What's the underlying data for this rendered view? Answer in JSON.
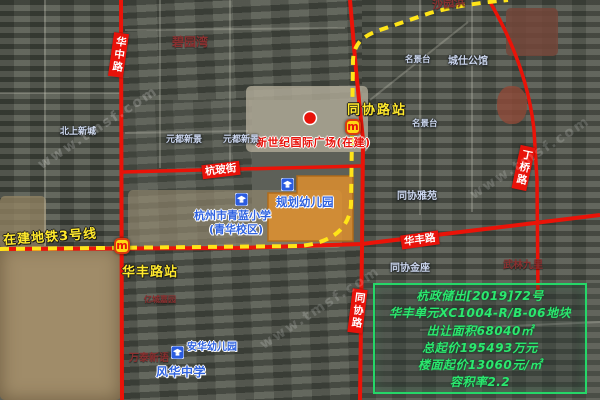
{
  "watermark": "www.tmsf.com",
  "roads": {
    "huazhong": "华中路",
    "hangbo": "杭玻街",
    "huafeng": "华丰路",
    "tongxie": "同协路",
    "dingqiao": "丁桥路"
  },
  "metro": {
    "line_label": "在建地铁3号线",
    "station_tongxie": "同协路站",
    "station_huafeng": "华丰路站",
    "logo_letter": "m"
  },
  "landmarks": {
    "plaza": "新世纪国际广场(在建)",
    "kindergarten_planned": "规划幼儿园",
    "school_line1": "杭州市青蓝小学",
    "school_line2": "(青华校区)",
    "anhua_kindergarten": "安华幼儿园",
    "fenghua_school": "风华中学"
  },
  "poi": {
    "beishang": "北上新城",
    "yuandu1": "元都新景",
    "yuandu2": "元都新景",
    "biyuanwan": "碧园湾",
    "shayuanbang": "沙园浜",
    "mingjingtai1": "名景台",
    "chengshi": "城仕公馆",
    "mingjingtai2": "名景台",
    "tongxieyayuan": "同协雅苑",
    "tongxiejinzuo": "同协金座",
    "wulin": "武林九里",
    "yicheng": "亿城嘉园",
    "wantai": "万泰新语"
  },
  "parcel_notice": {
    "lines": [
      "杭政储出[2019]72号",
      "华丰单元XC1004-R/B-06地块",
      "出让面积68040㎡",
      "总起价195493万元",
      "楼面起价13060元/㎡",
      "容积率2.2"
    ]
  },
  "colors": {
    "road_red": "#ea1308",
    "metro_yellow": "#ffe418",
    "parcel_orange": "#e0902c",
    "annotation_blue": "#2f62e0",
    "notice_green": "#2be86e"
  }
}
